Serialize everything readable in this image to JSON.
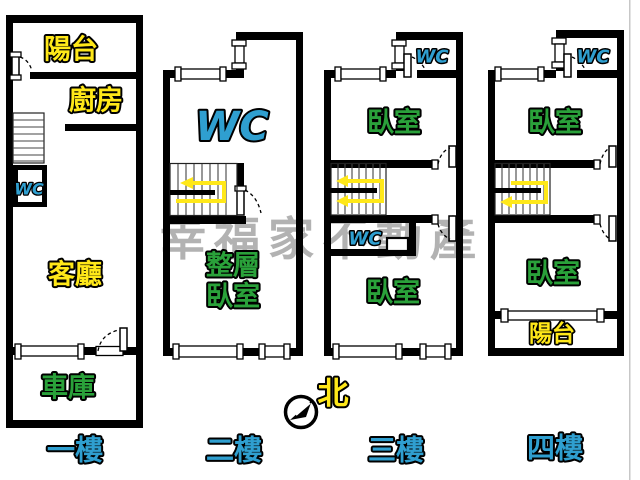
{
  "palette": {
    "background": "#ffffff",
    "wall": "#000000",
    "label_yellow": "#ffe819",
    "label_green": "#2aa13a",
    "label_blue": "#2f9fd0",
    "stair_arrow_yellow": "#ffe819",
    "watermark_gray": "#a5a5a5"
  },
  "watermark": {
    "text": "幸福家不動產"
  },
  "compass": {
    "north_label": "北"
  },
  "floors": [
    {
      "label": "一樓",
      "rooms": {
        "balcony": "陽台",
        "kitchen": "廚房",
        "wc": "WC",
        "living_room": "客廳",
        "garage": "車庫"
      }
    },
    {
      "label": "二樓",
      "rooms": {
        "wc": "WC",
        "bedroom_line1": "整層",
        "bedroom_line2": "臥室"
      }
    },
    {
      "label": "三樓",
      "rooms": {
        "wc_upper": "WC",
        "bedroom_upper": "臥室",
        "wc_middle": "WC",
        "bedroom_lower": "臥室"
      }
    },
    {
      "label": "四樓",
      "rooms": {
        "wc_upper": "WC",
        "bedroom_upper": "臥室",
        "bedroom_lower": "臥室",
        "balcony": "陽台"
      }
    }
  ]
}
